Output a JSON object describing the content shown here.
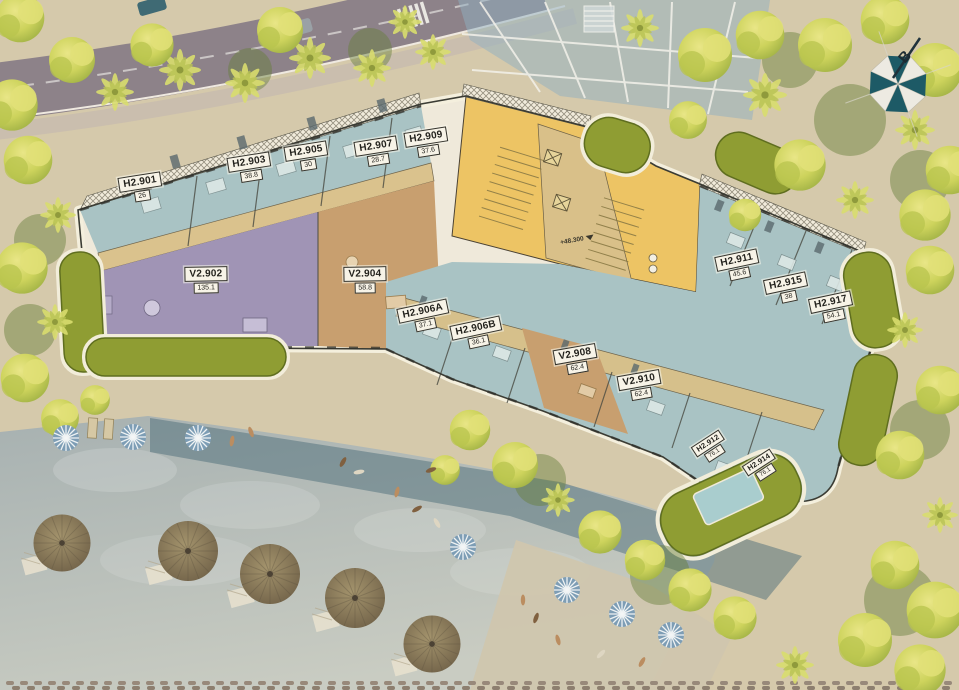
{
  "units": [
    {
      "id": "H2.901",
      "area": "26"
    },
    {
      "id": "H2.903",
      "area": "38.8"
    },
    {
      "id": "H2.905",
      "area": "30"
    },
    {
      "id": "H2.907",
      "area": "28.7"
    },
    {
      "id": "H2.909",
      "area": "37.6"
    },
    {
      "id": "V2.902",
      "area": "135.1"
    },
    {
      "id": "V2.904",
      "area": "58.8"
    },
    {
      "id": "H2.906A",
      "area": "37.1"
    },
    {
      "id": "H2.906B",
      "area": "36.1"
    },
    {
      "id": "V2.908",
      "area": "62.4"
    },
    {
      "id": "V2.910",
      "area": "62.4"
    },
    {
      "id": "H2.911",
      "area": "45.6"
    },
    {
      "id": "H2.915",
      "area": "38"
    },
    {
      "id": "H2.917",
      "area": "54.1"
    },
    {
      "id": "H2.912",
      "area": "76.1"
    },
    {
      "id": "H2.914",
      "area": "76.1"
    }
  ],
  "annotations": {
    "elevation": "+48.300"
  },
  "compass": {
    "label": "B"
  },
  "colors": {
    "unit_teal": "#a9c3c4",
    "unit_purple": "#a094b5",
    "unit_brown": "#c89f6f",
    "core_yellow": "#edc464",
    "corridor_tan": "#d9c089",
    "roof_olive": "#8f9d33",
    "water": "#b9c1bd",
    "compass_teal": "#1d5a66",
    "label_bg": "#f7f3e7"
  }
}
